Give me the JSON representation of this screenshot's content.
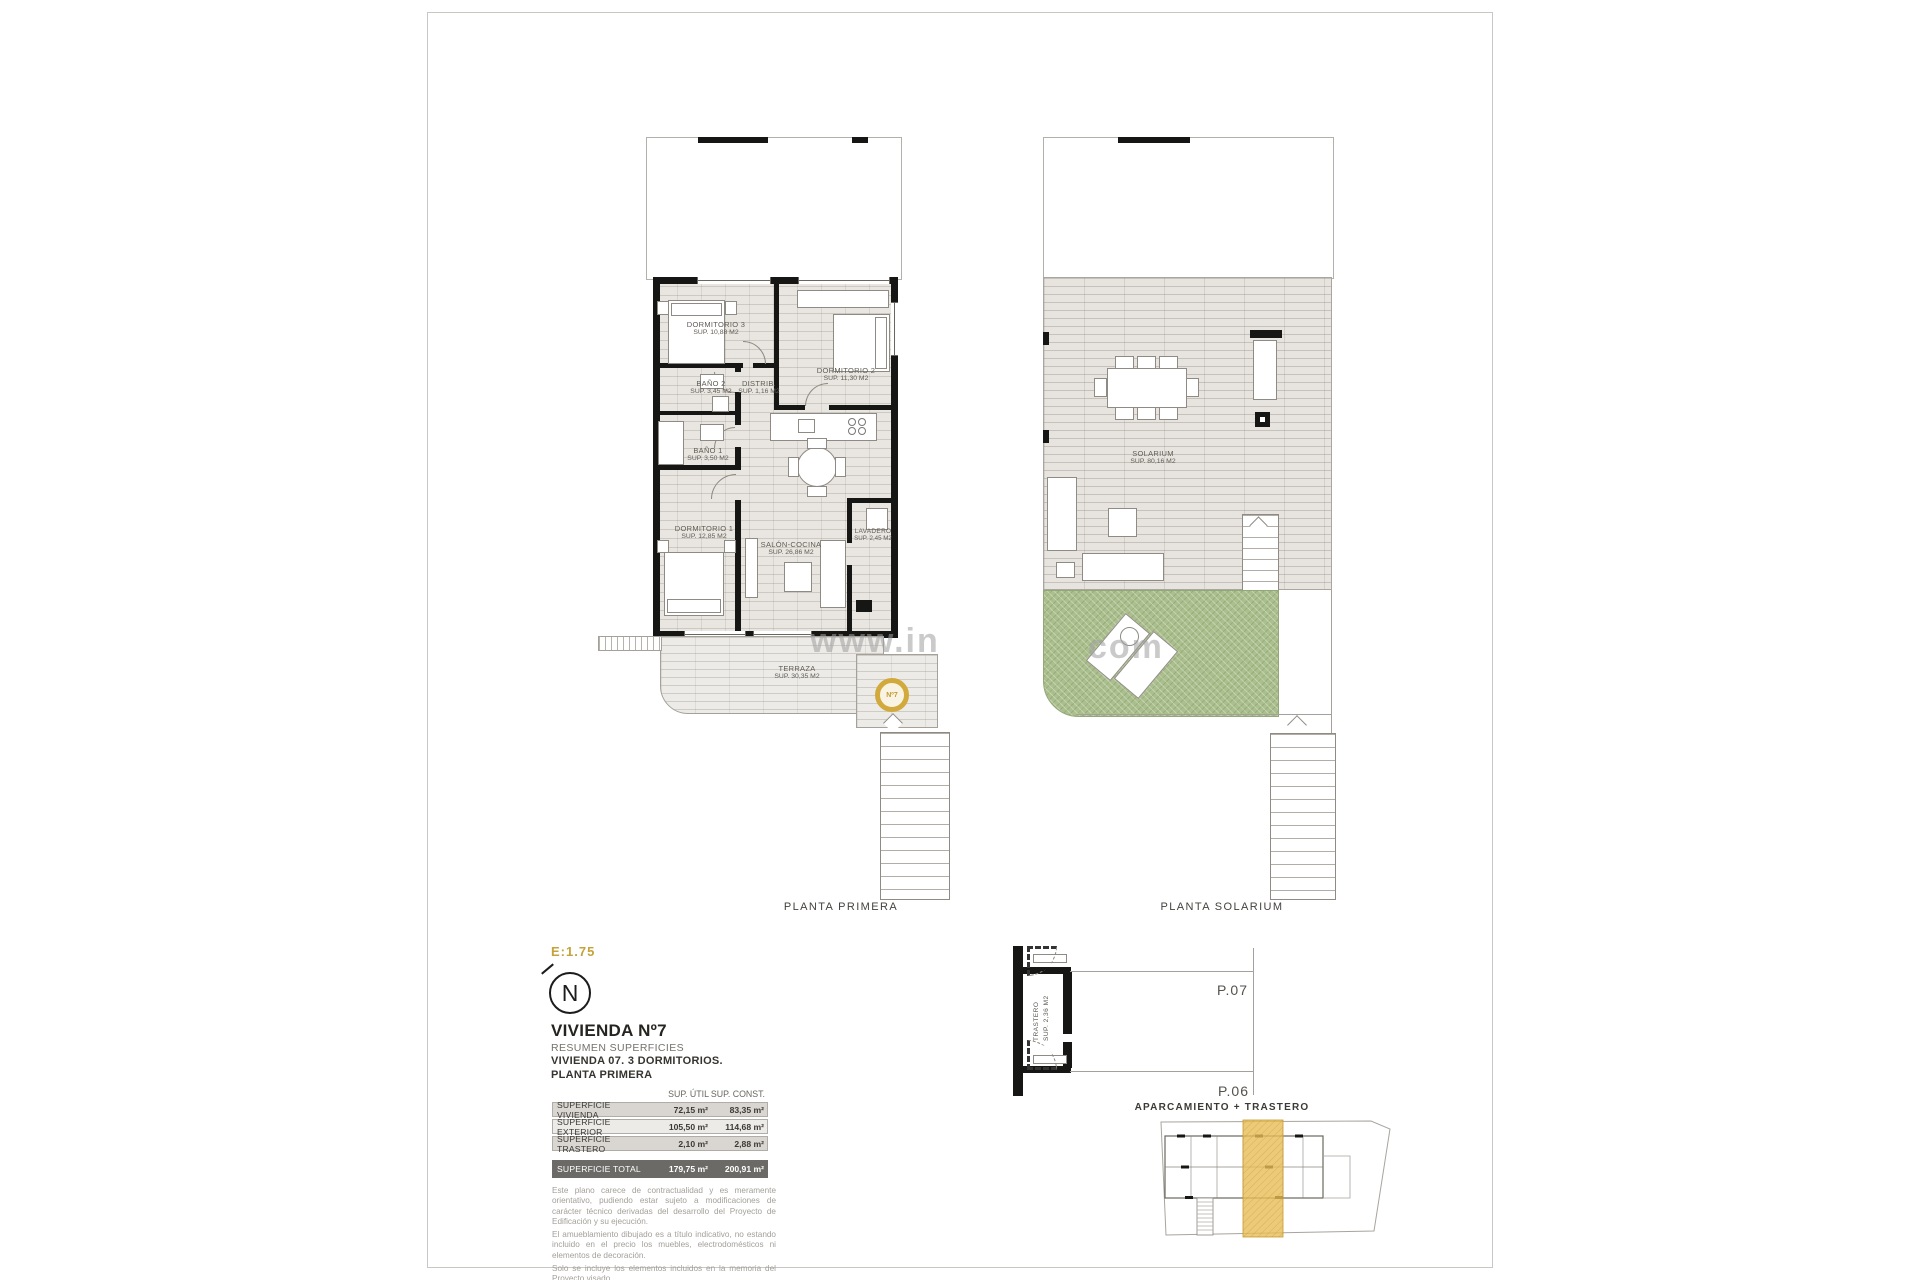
{
  "colors": {
    "accent_gold": "#C7A13C",
    "garden_green": "#AABF8D",
    "site_highlight": "#E7BD55",
    "total_row_bg": "#6B6A67"
  },
  "watermark": {
    "left": "www.in",
    "right": "com"
  },
  "plan_primera": {
    "caption": "PLANTA PRIMERA",
    "badge": "Nº7",
    "rooms": {
      "dormitorio3": {
        "name": "DORMITORIO 3",
        "area": "SUP. 10,88 M2"
      },
      "dormitorio2": {
        "name": "DORMITORIO 2",
        "area": "SUP. 11,30 M2"
      },
      "bano2": {
        "name": "BAÑO 2",
        "area": "SUP. 3,45 M2"
      },
      "distribuidor": {
        "name": "DISTRIB.",
        "area": "SUP. 1,16 M2"
      },
      "bano1": {
        "name": "BAÑO 1",
        "area": "SUP. 3,50 M2"
      },
      "dormitorio1": {
        "name": "DORMITORIO 1",
        "area": "SUP. 12,85 M2"
      },
      "salon": {
        "name": "SALÓN-COCINA",
        "area": "SUP. 26,86 M2"
      },
      "lavadero": {
        "name": "LAVADERO",
        "area": "SUP. 2,45 M2"
      },
      "terraza": {
        "name": "TERRAZA",
        "area": "SUP. 30,35 M2"
      }
    }
  },
  "plan_solarium": {
    "caption": "PLANTA SOLARIUM",
    "rooms": {
      "solarium": {
        "name": "SOLARIUM",
        "area": "SUP. 80,16 M2"
      }
    }
  },
  "title_block": {
    "scale": "E:1.75",
    "north": "N",
    "title": "VIVIENDA Nº7",
    "subtitle": "RESUMEN SUPERFICIES",
    "line2": "VIVIENDA 07. 3 DORMITORIOS.",
    "line3": "PLANTA PRIMERA"
  },
  "surface_table": {
    "header_util": "SUP. ÚTIL",
    "header_const": "SUP. CONST.",
    "rows": [
      {
        "label": "SUPERFICIE VIVIENDA",
        "util": "72,15 m²",
        "const": "83,35 m²"
      },
      {
        "label": "SUPERFICIE EXTERIOR",
        "util": "105,50 m²",
        "const": "114,68 m²"
      },
      {
        "label": "SUPERFICIE TRASTERO",
        "util": "2,10 m²",
        "const": "2,88 m²"
      }
    ],
    "total": {
      "label": "SUPERFICIE TOTAL",
      "util": "179,75 m²",
      "const": "200,91 m²"
    }
  },
  "disclaimer": {
    "p1": "Este plano carece de contractualidad y es meramente orientativo, pudiendo estar sujeto a modificaciones de carácter técnico derivadas del desarrollo del Proyecto de Edificación y su ejecución.",
    "p2": "El amueblamiento dibujado es a título indicativo, no estando incluido en el precio los muebles, electrodomésticos ni elementos de decoración.",
    "p3": "Solo se incluye los elementos incluidos en la memoria del Proyecto visado."
  },
  "parking": {
    "caption": "APARCAMIENTO + TRASTERO",
    "p07": "P.07",
    "p06": "P.06",
    "trastero_name": "TRASTERO",
    "trastero_area": "SUP. 2,36 M2"
  }
}
